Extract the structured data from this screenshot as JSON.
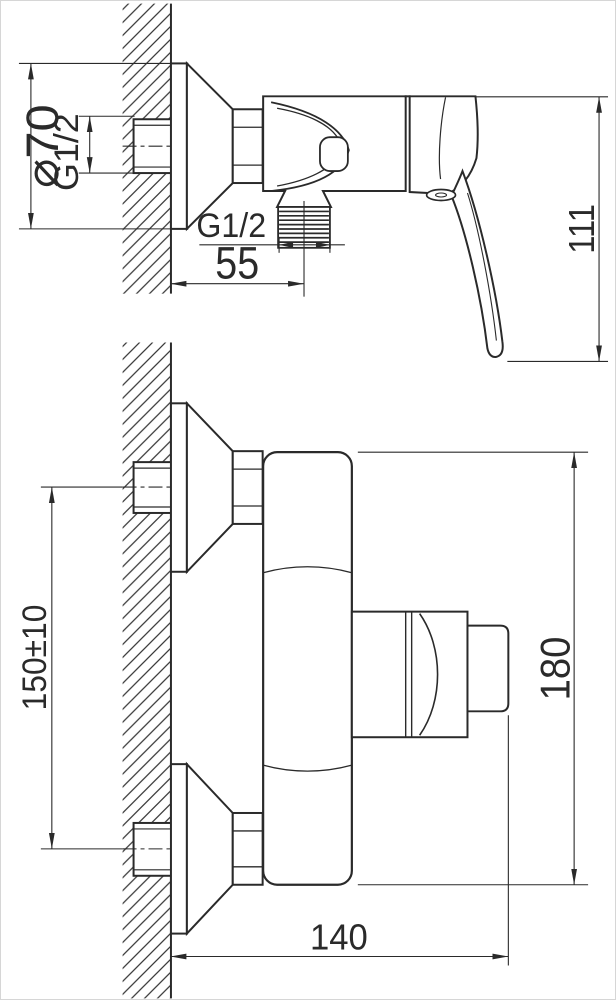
{
  "drawing": {
    "background": "#ffffff",
    "line_color": "#2a2a2a",
    "side_view": {
      "dim_flange_diameter": "⌀70",
      "dim_wall_thread": "G1/2",
      "dim_outlet_thread": "G1/2",
      "dim_outlet_offset": "55",
      "dim_height": "111"
    },
    "front_view": {
      "dim_connection_spacing": "150±10",
      "dim_overall_height": "180",
      "dim_overall_width": "140"
    }
  }
}
